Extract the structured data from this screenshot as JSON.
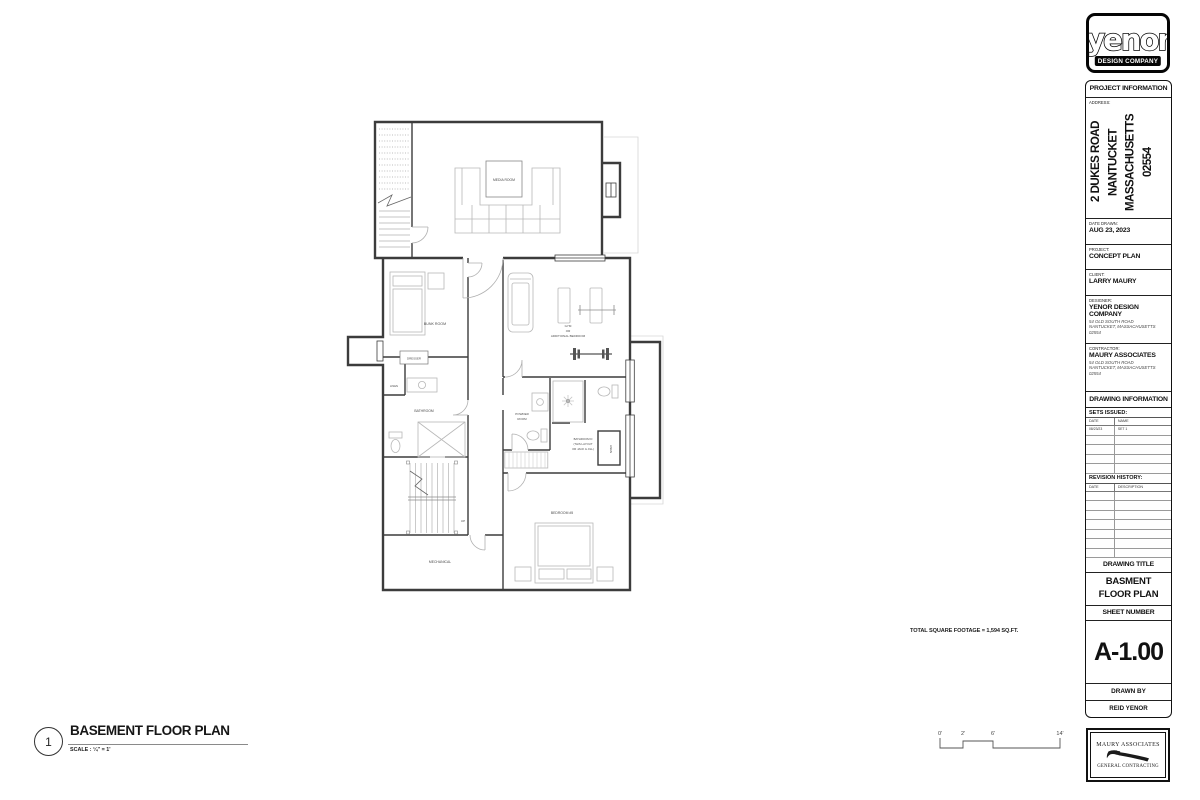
{
  "logo": {
    "name": "yenor",
    "tagline": "DESIGN COMPANY"
  },
  "project_info": {
    "header": "PROJECT INFORMATION",
    "address_label": "ADDRESS:",
    "address_line1": "2 DUKES ROAD",
    "address_line2": "NANTUCKET",
    "address_line3": "MASSACHUSETTS",
    "address_line4": "02554",
    "date_drawn_label": "DATE DRAWN:",
    "date_drawn": "AUG 23, 2023",
    "project_label": "PROJECT:",
    "project": "CONCEPT PLAN",
    "client_label": "CLIENT:",
    "client": "LARRY MAURY",
    "designer_label": "DESIGNER:",
    "designer_name": "YENOR DESIGN COMPANY",
    "designer_addr1": "54 OLD SOUTH ROAD",
    "designer_addr2": "NANTUCKET, MASSACHUSETTS",
    "designer_addr3": "02554",
    "contractor_label": "CONTRACTOR:",
    "contractor_name": "MAURY ASSOCIATES",
    "contractor_addr1": "54 OLD SOUTH ROAD",
    "contractor_addr2": "NANTUCKET, MASSACHUSETTS",
    "contractor_addr3": "02554"
  },
  "drawing_info": {
    "header": "DRAWING INFORMATION",
    "sets_issued_label": "SETS ISSUED:",
    "sets_col_date": "DATE",
    "sets_col_name": "NAME",
    "set1_date": "08/23/23",
    "set1_name": "SET 1",
    "revision_label": "REVISION HISTORY:",
    "rev_col_date": "DATE",
    "rev_col_desc": "DESCRIPTION"
  },
  "sheet": {
    "drawing_title_label": "DRAWING TITLE",
    "title_line1": "BASMENT",
    "title_line2": "FLOOR PLAN",
    "sheet_number_label": "SHEET NUMBER",
    "sheet_number": "A-1.00",
    "drawn_by_label": "DRAWN BY",
    "drawn_by": "REID YENOR"
  },
  "maury_logo": {
    "line1": "MAURY ASSOCIATES",
    "line2": "GENERAL CONTRACTING"
  },
  "plan_labels": {
    "media_room": "MEDIA ROOM",
    "bunk_room": "BUNK ROOM",
    "dresser": "DRESSER",
    "linen_1": "LINEN",
    "bathroom": "BATHROOM",
    "gym_line1": "GYM",
    "gym_line2": "OR",
    "gym_line3": "ADDITIONAL BEDROOM",
    "powder_line1": "POWDER",
    "powder_line2": "ROOM",
    "bath_d_line1": "BATHROOM D",
    "bath_d_line2": "(THIS LAYOUT",
    "bath_d_line3": "OR JACK & JILL)",
    "linen_2": "LINEN",
    "bedroom5": "BEDROOM #5",
    "mechanical": "MECHANICAL",
    "up": "UP"
  },
  "footer": {
    "detail_number": "1",
    "title": "BASEMENT FLOOR PLAN",
    "scale": "SCALE : ¼\" = 1'"
  },
  "notes": {
    "total_sqft": "TOTAL SQUARE FOOTAGE = 1,594 SQ.FT."
  },
  "scale_bar": {
    "t0": "0'",
    "t1": "2'",
    "t2": "6'",
    "t3": "14'"
  },
  "colors": {
    "ink": "#111111",
    "wall": "#3c3c3c",
    "light_line": "#b8b8b8"
  }
}
